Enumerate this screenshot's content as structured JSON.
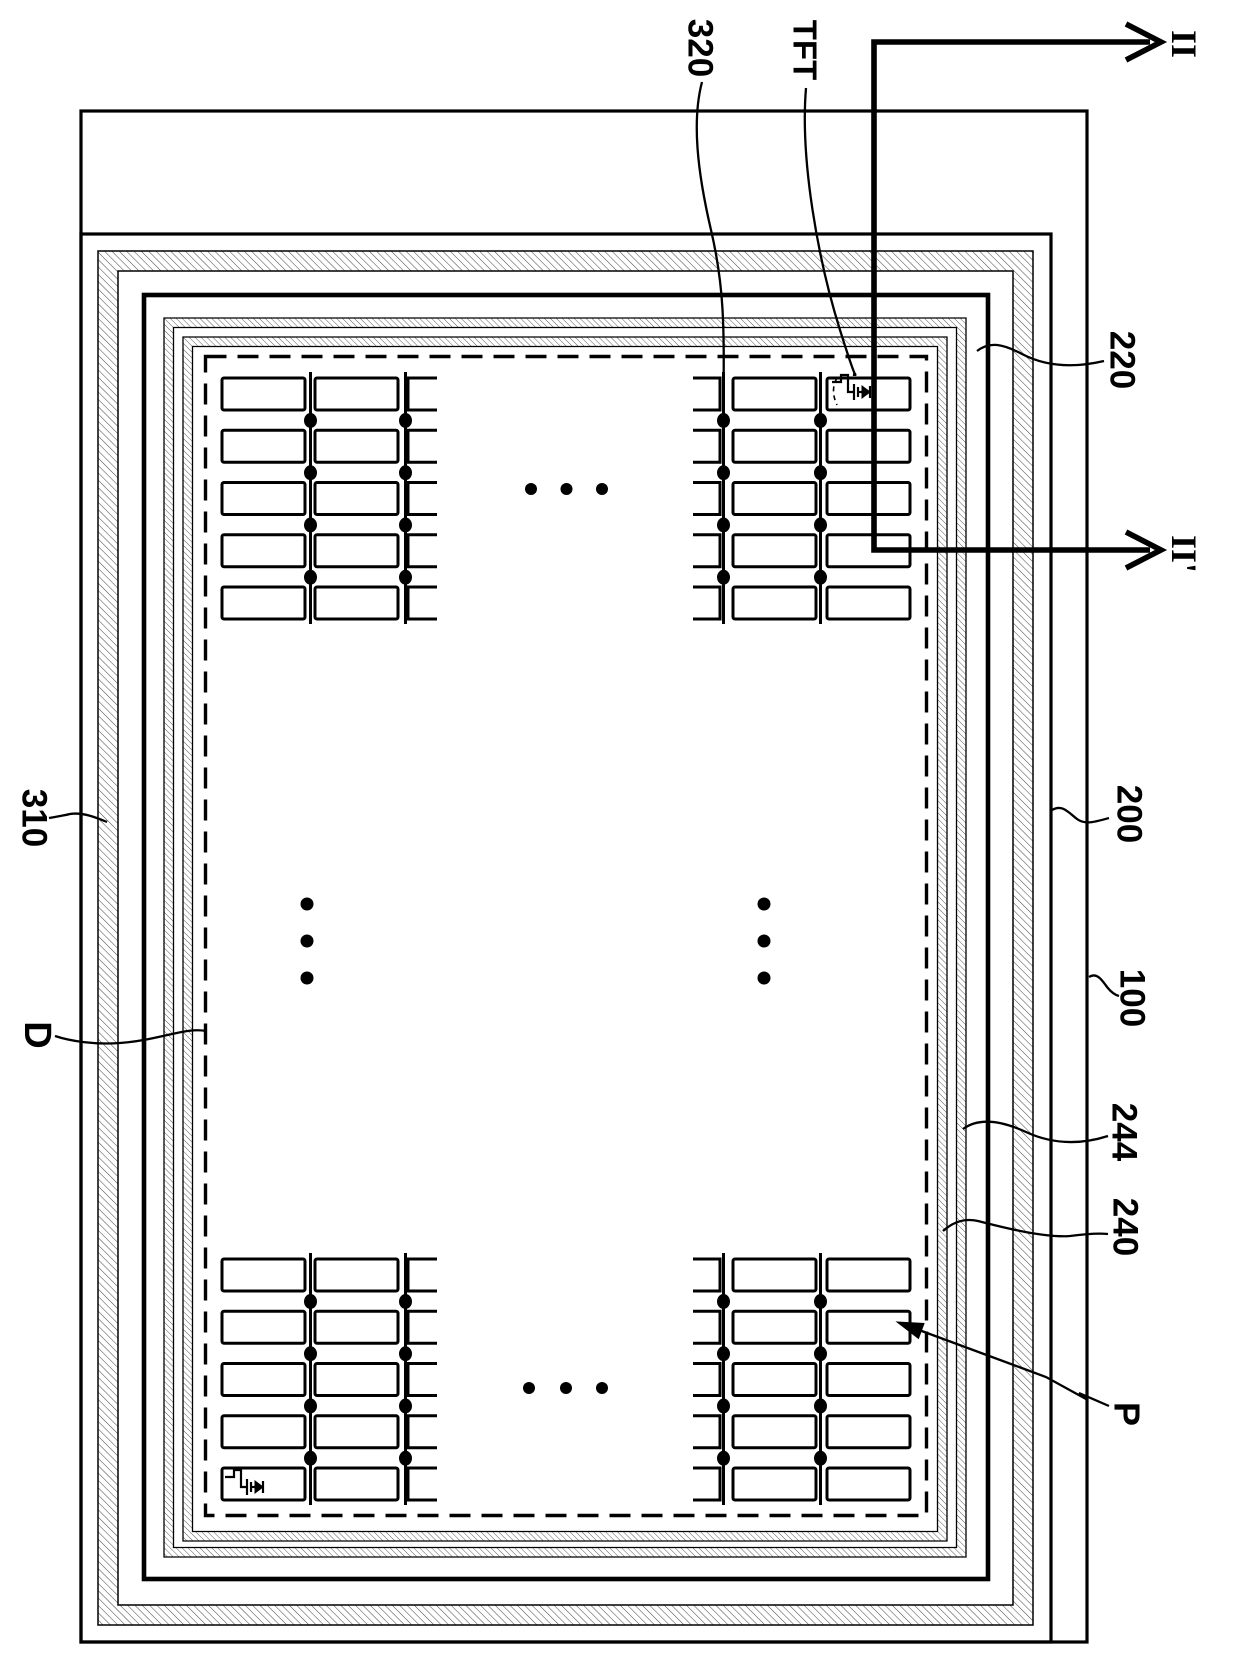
{
  "figure": {
    "type": "patent-plan-view-display-panel",
    "labels": {
      "line_320": "320",
      "tft": "TFT",
      "section_start": "II",
      "section_end": "II'",
      "ref_220": "220",
      "ref_200": "200",
      "ref_100": "100",
      "ref_244": "244",
      "ref_240": "240",
      "pixel_p": "P",
      "ref_310": "310",
      "display_area_d": "D"
    }
  }
}
